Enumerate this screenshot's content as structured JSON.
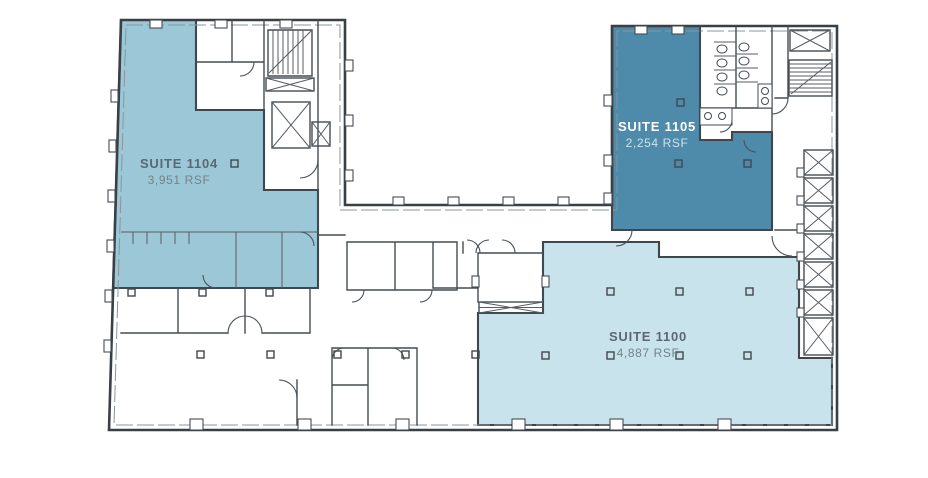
{
  "suites": {
    "s1104": {
      "name": "SUITE 1104",
      "rsf": "3,951 RSF",
      "color": "#9cc7d7",
      "name_color": "#5a6872",
      "rsf_color": "#74828a"
    },
    "s1105": {
      "name": "SUITE 1105",
      "rsf": "2,254 RSF",
      "color": "#4e8aa9",
      "name_color": "#ffffff",
      "rsf_color": "#cfe2ec"
    },
    "s1100": {
      "name": "SUITE 1100",
      "rsf": "4,887 RSF",
      "color": "#c9e3ed",
      "name_color": "#5a6872",
      "rsf_color": "#74828a"
    }
  },
  "colors": {
    "wall": "#3f464c",
    "background": "#ffffff"
  }
}
